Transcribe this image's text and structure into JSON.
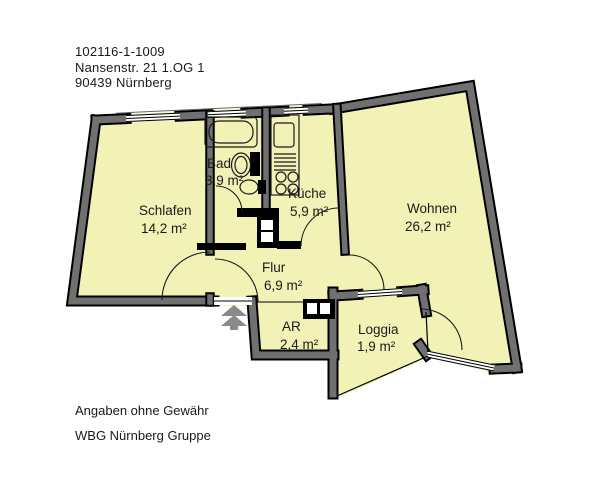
{
  "header": {
    "object_id": "102116-1-1009",
    "address": "Nansenstr. 21 1.OG 1",
    "city": "90439 Nürnberg"
  },
  "footer": {
    "disclaimer": "Angaben ohne Gewähr",
    "company": "WBG Nürnberg Gruppe"
  },
  "rooms": {
    "schlafen": {
      "name": "Schlafen",
      "area": "14,2 m²"
    },
    "bad": {
      "name": "Bad",
      "area": "3,9 m²"
    },
    "kueche": {
      "name": "Küche",
      "area": "5,9 m²"
    },
    "wohnen": {
      "name": "Wohnen",
      "area": "26,2 m²"
    },
    "flur": {
      "name": "Flur",
      "area": "6,9 m²"
    },
    "ar": {
      "name": "AR",
      "area": "2,4 m²"
    },
    "loggia": {
      "name": "Loggia",
      "area": "1,9 m²"
    }
  },
  "icons": {
    "entrance_arrow": "double-chevron-up",
    "bathtub": "bathtub-plan-symbol",
    "sink": "washbasin-plan-symbol",
    "toilet": "wc-plan-symbol",
    "stove": "4-burner-stove-symbol",
    "shaft": "duct-shaft-symbol"
  },
  "colors": {
    "floor": "#F2F2B6",
    "wall_fill": "#707070",
    "wall_outline": "#000000",
    "window": "#FFFFFF",
    "arrow": "#8A8A8A",
    "text": "#1A1A1A",
    "background": "#FFFFFF"
  }
}
